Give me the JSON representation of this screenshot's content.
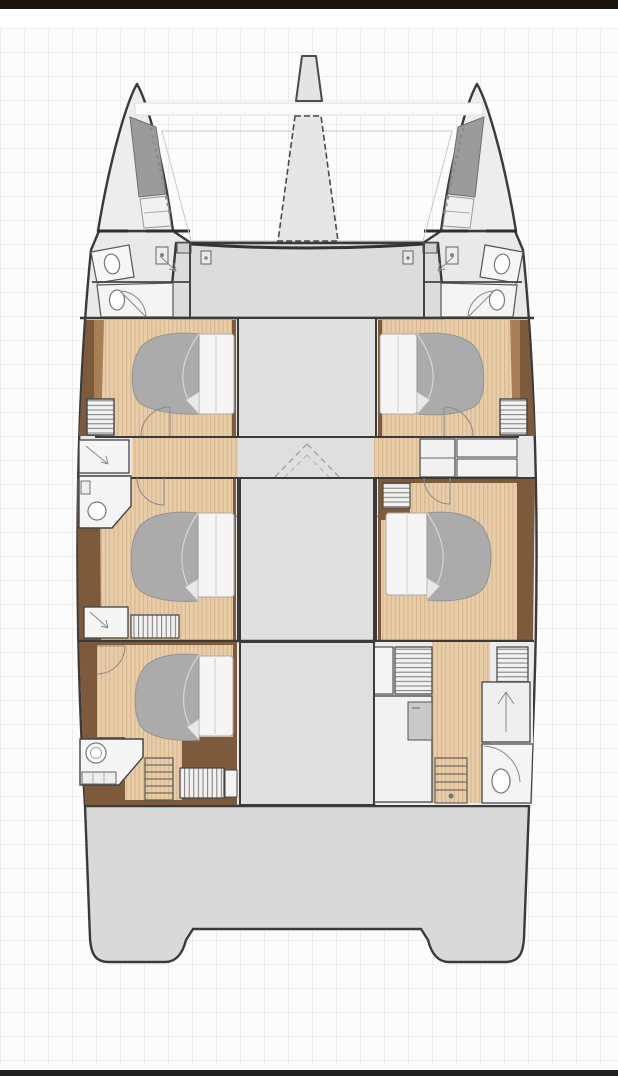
{
  "meta": {
    "title": "catamaran-floor-plan",
    "type": "boat-deck-plan",
    "orientation": "bow-up",
    "visible_text": ""
  },
  "frame": {
    "width_px": 618,
    "height_px": 1076,
    "top_bar_color": "#1a1410",
    "bottom_bar_color": "#202020",
    "background": "#fdfcfc",
    "grid_color": "#efecec",
    "grid_size_px": 24
  },
  "palette": {
    "bg": "#fdfcfc",
    "grid": "#efecec",
    "barTop": "#1a1410",
    "barBottom": "#202020",
    "outline": "#3a3a3a",
    "wall": "#4a4a4a",
    "detail": "#8a8a8a",
    "hull": "#e9e9e9",
    "bow": "#ededed",
    "deck": "#dcdcdc",
    "saloon": "#dfdfdf",
    "stern": "#d9d9d9",
    "locker": "#9b9b9b",
    "room": "#f4f4f4",
    "fixture": "#ffffff",
    "woodDark": "#7d5a3b",
    "woodMid": "#a87e57",
    "floor": "#e8cda8",
    "grain": "#d2b28a",
    "duvet": "#ababab",
    "duvetEdge": "#949494",
    "pillow": "#f5f5f5",
    "crease": "#d6d6d6",
    "cabinet": "#f1f1f1",
    "stripe": "#6f6f6f",
    "appliance": "#c9c9c9",
    "beam": "#fbfbfb",
    "beamEdge": "#dddddd",
    "tramp": "#c8c8c8",
    "dash": "#9a9a9a"
  },
  "plan": {
    "vessel": "catamaran",
    "features": {
      "double_cabins": 5,
      "beds": 5,
      "toilets": 6,
      "sinks": 2,
      "showers": 4,
      "wardrobes": 7,
      "staircases": 3,
      "trampolines": 2,
      "bow_lockers": 2,
      "swim_platform_legs": 2
    },
    "rooms": [
      {
        "id": "bow-locker-port",
        "type": "anchor-locker",
        "side": "port"
      },
      {
        "id": "bow-locker-starboard",
        "type": "anchor-locker",
        "side": "starboard"
      },
      {
        "id": "head-fore-port-1",
        "type": "bathroom",
        "side": "port"
      },
      {
        "id": "head-fore-port-2",
        "type": "bathroom",
        "side": "port"
      },
      {
        "id": "head-fore-starboard-1",
        "type": "bathroom",
        "side": "starboard"
      },
      {
        "id": "head-fore-starboard-2",
        "type": "bathroom",
        "side": "starboard"
      },
      {
        "id": "cabin-fore-port",
        "type": "double-cabin",
        "side": "port"
      },
      {
        "id": "cabin-fore-starboard",
        "type": "double-cabin",
        "side": "starboard"
      },
      {
        "id": "saloon-forward",
        "type": "saloon",
        "side": "center"
      },
      {
        "id": "corridor-midship",
        "type": "corridor",
        "side": "center"
      },
      {
        "id": "saloon-main",
        "type": "saloon",
        "side": "center"
      },
      {
        "id": "head-mid-port",
        "type": "bathroom",
        "side": "port"
      },
      {
        "id": "cabin-mid-port",
        "type": "double-cabin",
        "side": "port"
      },
      {
        "id": "cabin-mid-starboard",
        "type": "double-cabin",
        "side": "starboard"
      },
      {
        "id": "cabin-aft-port",
        "type": "double-cabin",
        "side": "port"
      },
      {
        "id": "head-aft-port",
        "type": "bathroom",
        "side": "port"
      },
      {
        "id": "galley-aft-starboard",
        "type": "galley-utility",
        "side": "starboard"
      },
      {
        "id": "head-aft-starboard",
        "type": "bathroom",
        "side": "starboard"
      },
      {
        "id": "stairs-aft-port",
        "type": "staircase",
        "side": "port"
      },
      {
        "id": "stairs-aft-starboard",
        "type": "staircase",
        "side": "starboard"
      },
      {
        "id": "aft-deck",
        "type": "cockpit-platform",
        "side": "center"
      }
    ]
  }
}
